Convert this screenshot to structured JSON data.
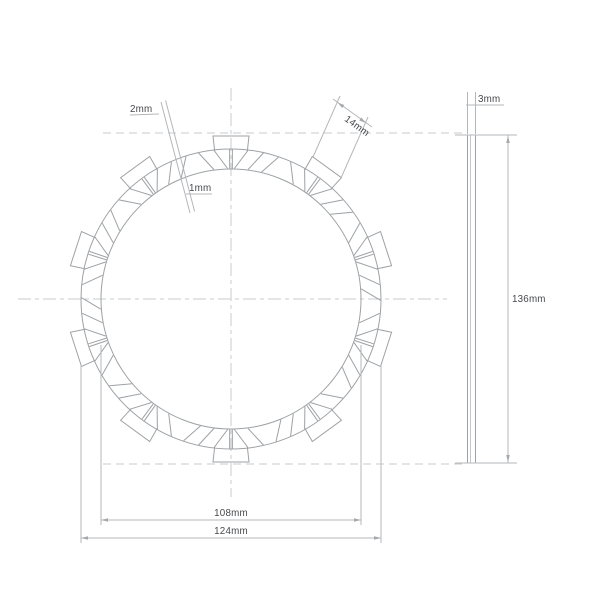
{
  "labels": {
    "groove_width": "2mm",
    "groove_inner_width": "1mm",
    "tab_width": "14mm",
    "plate_thickness": "3mm",
    "overall_diameter": "136mm",
    "friction_inner_diameter": "108mm",
    "friction_outer_diameter": "124mm"
  },
  "geometry": {
    "tab_count": 10,
    "segment_step_deg": 6
  }
}
